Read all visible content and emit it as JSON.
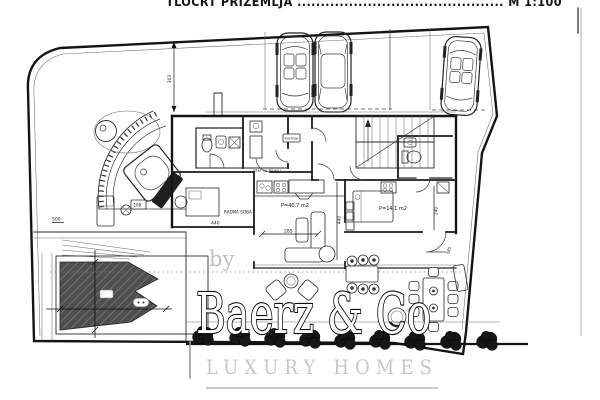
{
  "title_block": {
    "text": "TLOCRT PRIZEMLJA ............................................ M 1:100"
  },
  "watermark": {
    "by": "by",
    "brand": "Baerz & Co",
    "tagline": "LUXURY HOMES"
  },
  "labels": {
    "study_room": "RADNA SOBA",
    "living_area": "P=40.7 m2",
    "suite_area": "P=14.1 m2",
    "exit_note": "izlaz na terasu",
    "pantry": "kuhinja"
  },
  "dimensions": {
    "plot_left": "500",
    "study_width": "440",
    "living_width": "285",
    "living_depth": "440",
    "suite_depth": "240",
    "door_width": "385",
    "drive_depth": "303",
    "spa_step": "108"
  },
  "colors": {
    "paper": "#ffffff",
    "line": "#1c1c1c",
    "pool_fill": "#4e4e4e",
    "bush": "#161616",
    "watermark_gray": "#c0c0c0"
  }
}
